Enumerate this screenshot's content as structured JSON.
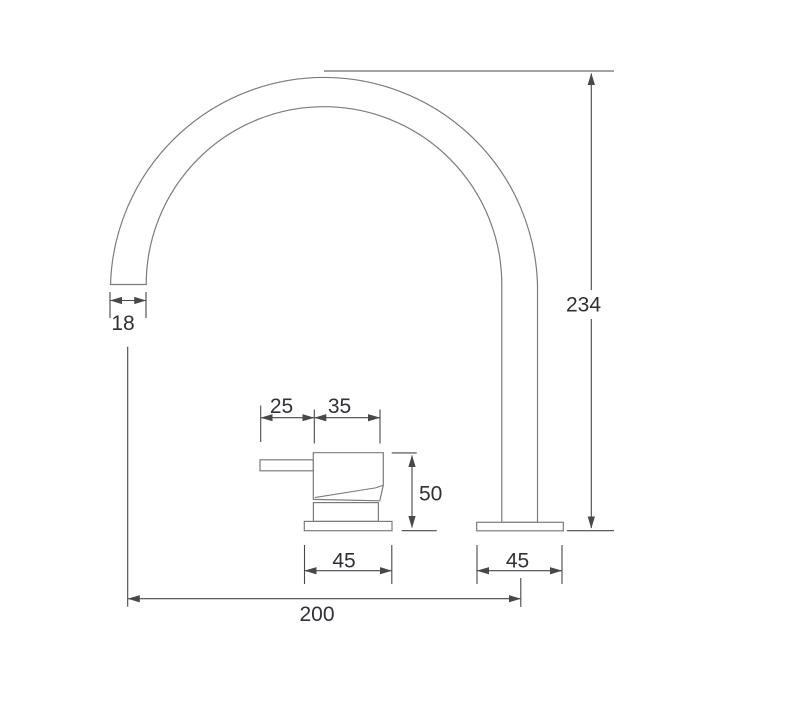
{
  "diagram": {
    "type": "technical-dimension-drawing",
    "labels": {
      "spout_tip_width": "18",
      "spout_height": "234",
      "lever_overhang": "25",
      "handle_body_width": "35",
      "handle_body_height": "50",
      "handle_base_width": "45",
      "spout_base_width": "45",
      "centre_to_centre": "200"
    },
    "colors": {
      "outline": "#7b7b80",
      "dimension_lines": "#47474c",
      "label_text": "#303036",
      "background": "#ffffff"
    }
  }
}
